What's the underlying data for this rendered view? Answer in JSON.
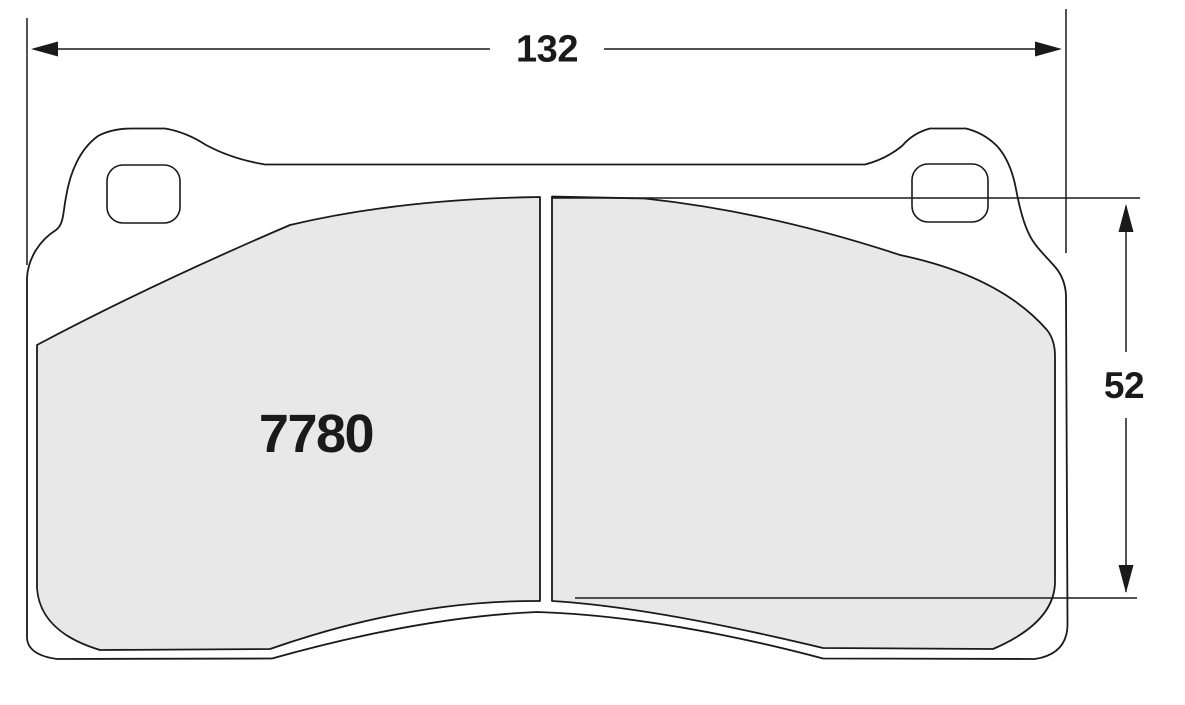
{
  "drawing": {
    "part_number": "7780",
    "dimensions": {
      "width": {
        "value": "132"
      },
      "height": {
        "value": "52"
      }
    },
    "colors": {
      "line": "#1a1a1a",
      "pad_fill": "#e8e8e8",
      "plate_fill": "#ffffff",
      "background": "#ffffff"
    }
  }
}
